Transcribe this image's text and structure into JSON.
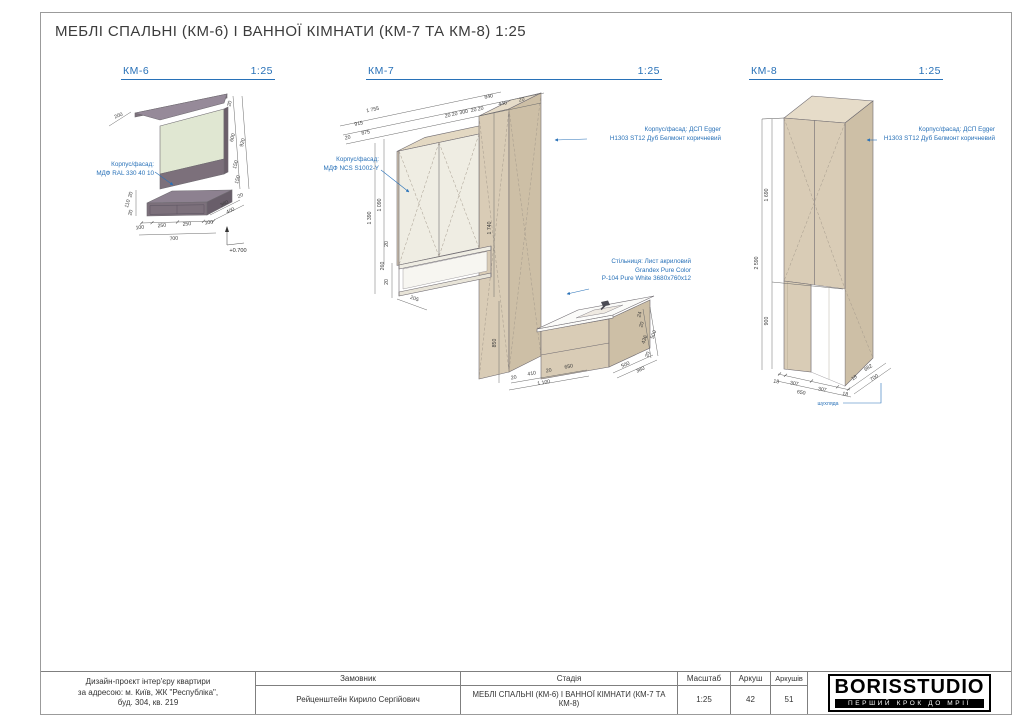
{
  "page": {
    "title": "МЕБЛІ СПАЛЬНІ (КМ-6) І ВАННОЇ КІМНАТИ (КМ-7 ТА КМ-8) 1:25"
  },
  "colors": {
    "accent_blue": "#2871b8",
    "km6_purple_front": "#7c707b",
    "km6_panel_green": "#e0e7d2",
    "oak_tan_front": "#d9ccb6",
    "cream_door": "#efede3",
    "countertop_white": "#fbfbf9"
  },
  "views": [
    {
      "id": "km6",
      "label": "КМ-6",
      "scale": "1:25",
      "material": [
        "Корпус/фасад:",
        "МДФ RAL 330 40 10"
      ],
      "level_mark": "+0.700",
      "dims": [
        "200",
        "20",
        "600",
        "920",
        "150",
        "150",
        "380",
        "400",
        "20",
        "20",
        "110",
        "20",
        "100",
        "250",
        "250",
        "100",
        "700"
      ]
    },
    {
      "id": "km7",
      "label": "КМ-7",
      "scale": "1:25",
      "material_left": [
        "Корпус/фасад:",
        "МДФ NCS S1002-Y"
      ],
      "material_right": [
        "Корпус/фасад: ДСП Egger",
        "H1303 ST12 Дуб Белмонт коричневий"
      ],
      "countertop": [
        "Стільниця: Лист акриловий",
        "Grandex Pure Color",
        "P-104 Pure White 3680x760x12"
      ],
      "dims": [
        "20",
        "875",
        "20",
        "20",
        "300",
        "20",
        "20",
        "440",
        "20",
        "915",
        "840",
        "1 755",
        "1 390",
        "1 090",
        "20",
        "260",
        "20",
        "205",
        "1 740",
        "850",
        "20",
        "410",
        "20",
        "650",
        "1 100",
        "24",
        "20",
        "436",
        "20",
        "500",
        "500",
        "380"
      ]
    },
    {
      "id": "km8",
      "label": "КМ-8",
      "scale": "1:25",
      "material_right": [
        "Корпус/фасад: ДСП Egger",
        "H1303 ST12 Дуб Белмонт коричневий"
      ],
      "drawer_label": "шухляда",
      "dims": [
        "1 690",
        "2 590",
        "900",
        "18",
        "307",
        "307",
        "18",
        "650",
        "18",
        "682",
        "700"
      ]
    }
  ],
  "titleblock": {
    "project_lines": [
      "Дизайн-проєкт інтер'єру квартири",
      "за адресою: м. Київ, ЖК \"Республіка\",",
      "буд. 304, кв. 219"
    ],
    "customer_label": "Замовник",
    "customer": "Рейценштейн Кирило Сергійович",
    "stage_label": "Стадія",
    "stage": "МЕБЛІ СПАЛЬНІ (КМ-6) І ВАННОЇ КІМНАТИ (КМ-7 ТА КМ-8)",
    "scale_label": "Масштаб",
    "scale": "1:25",
    "sheet_label": "Аркуш",
    "sheet": "42",
    "sheets_label": "Аркушів",
    "sheets": "51",
    "logo": "BORISSTUDIO",
    "tagline": "ПЕРШИЙ КРОК ДО МРІЇ"
  }
}
